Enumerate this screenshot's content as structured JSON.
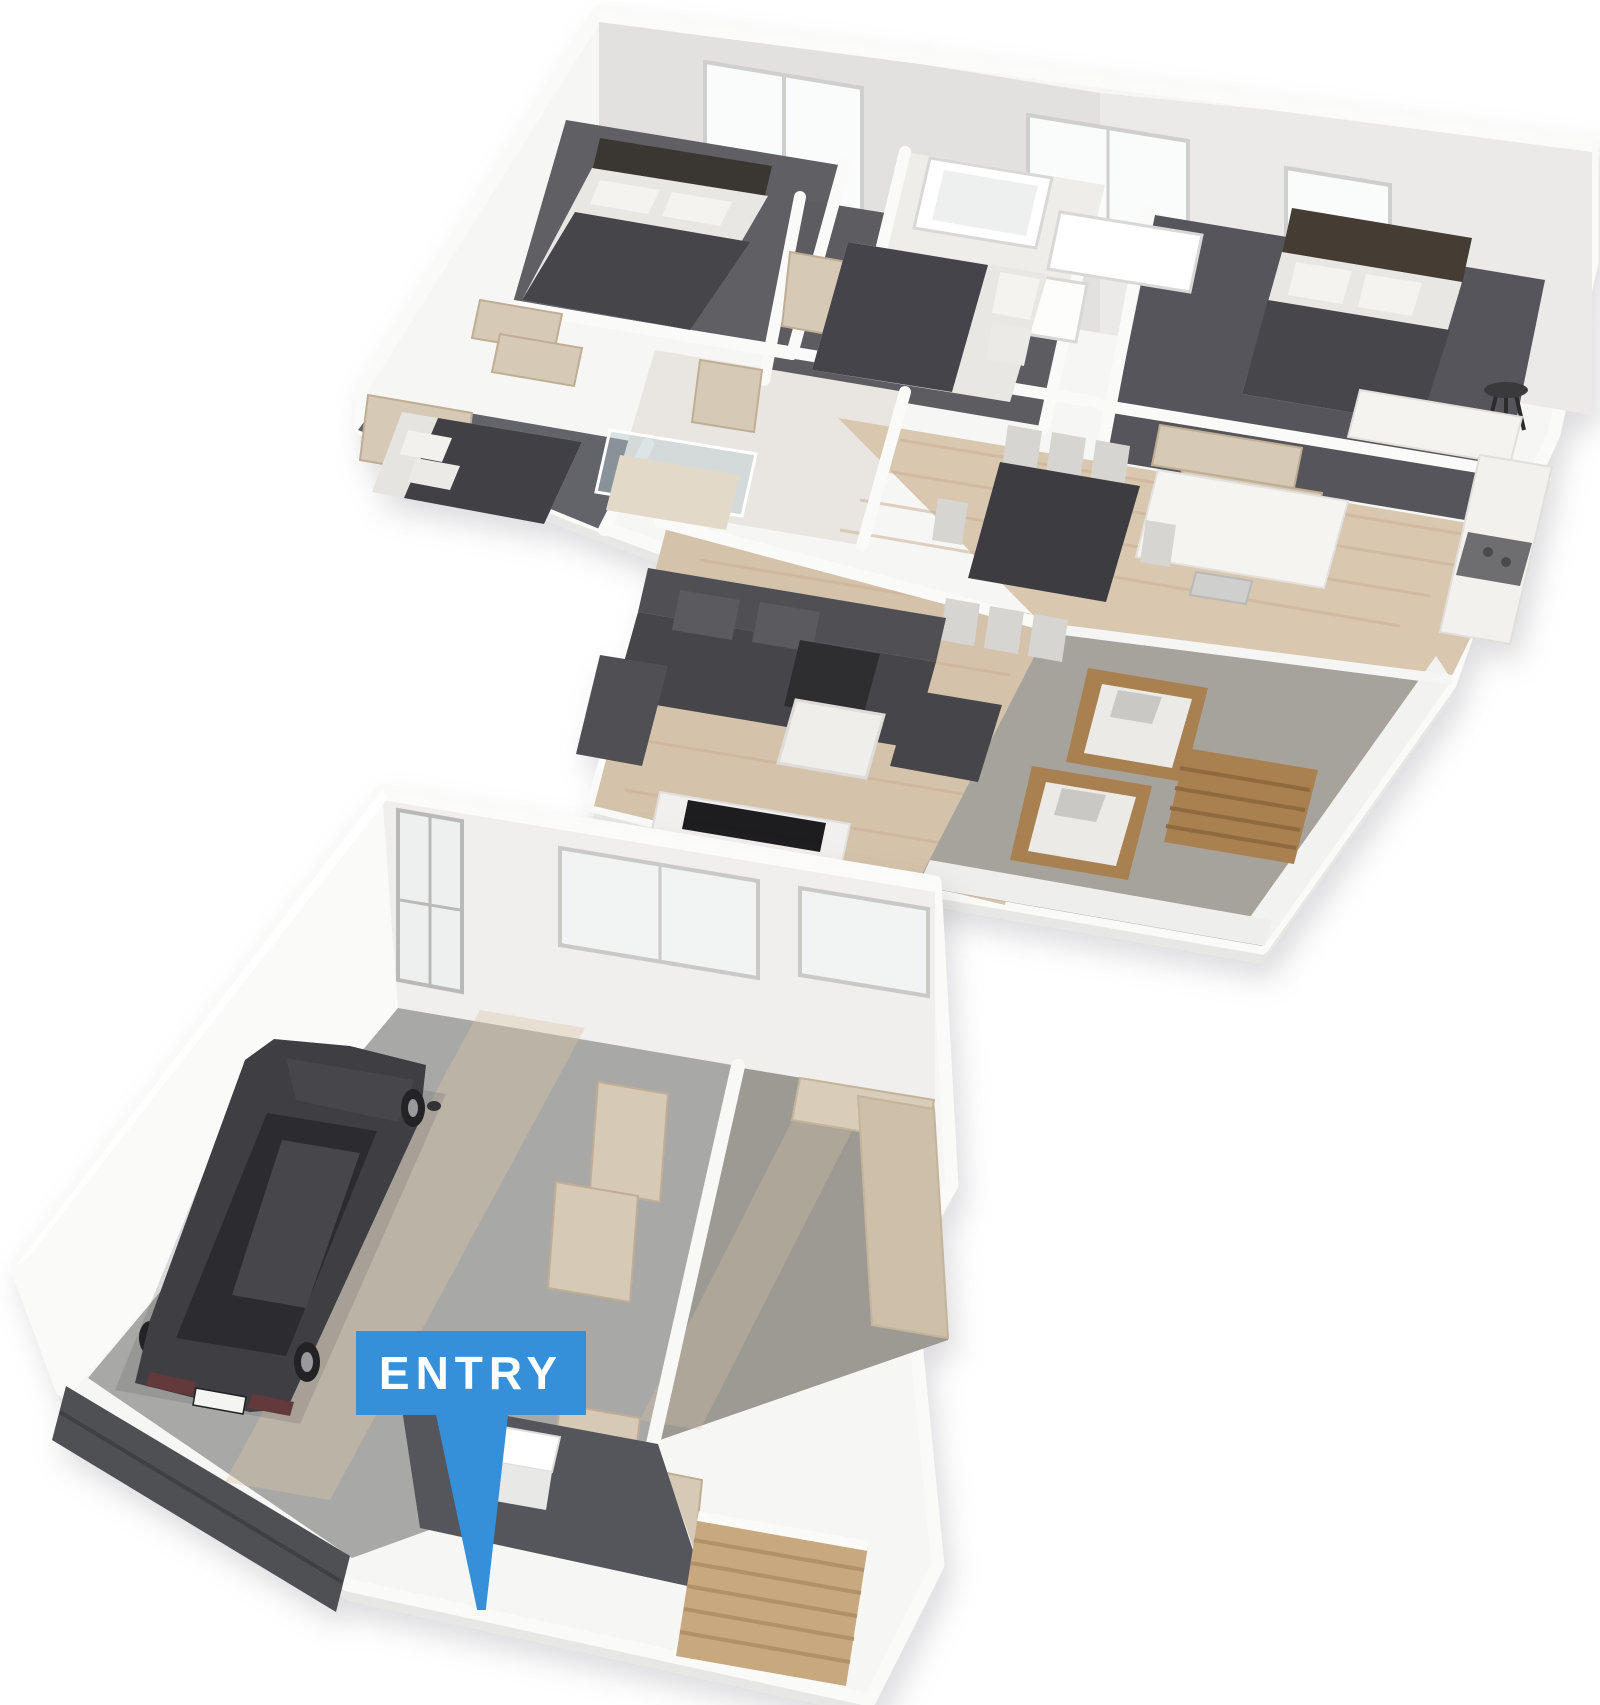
{
  "scene": {
    "description": "3D isometric cut-away render of a two-storey home floor plan",
    "entry_marker": {
      "label": "ENTRY"
    },
    "colors": {
      "accent_blue": "#3690d9",
      "marker_text": "#ffffff",
      "background": "#ffffff",
      "wall_white": "#f7f7f5",
      "wall_shade": "#e4e3e1",
      "carpet_dark": "#5f5f64",
      "carpet_rumpus": "#9d9a94",
      "wood_floor": "#d9c7b0",
      "tile_light": "#eae7e2",
      "patio_concrete": "#a6a39d",
      "garage_concrete": "#a8a8a6",
      "entry_floor": "#55565b",
      "garage_door_dark": "#4f5054",
      "stair_timber": "#c8a87e",
      "timber_panel": "#d6c9b6",
      "outdoor_timber": "#a9804f",
      "sofa_charcoal": "#4b4b4f",
      "furniture_dark": "#3d3d41",
      "car_body": "#3f3f43",
      "bedding_dark": "#46464a",
      "pillow_white": "#f2f1ee"
    },
    "upper_floor": {
      "name": "upper-floor",
      "rooms": [
        "bedroom-2",
        "bedroom-3",
        "bedroom-1",
        "bathroom",
        "hallway",
        "master-bedroom",
        "walk-in-robe",
        "kitchen",
        "dining",
        "living",
        "patio"
      ]
    },
    "lower_floor": {
      "name": "lower-floor",
      "rooms": [
        "garage",
        "rumpus-room",
        "entry-hall",
        "staircase"
      ]
    }
  }
}
